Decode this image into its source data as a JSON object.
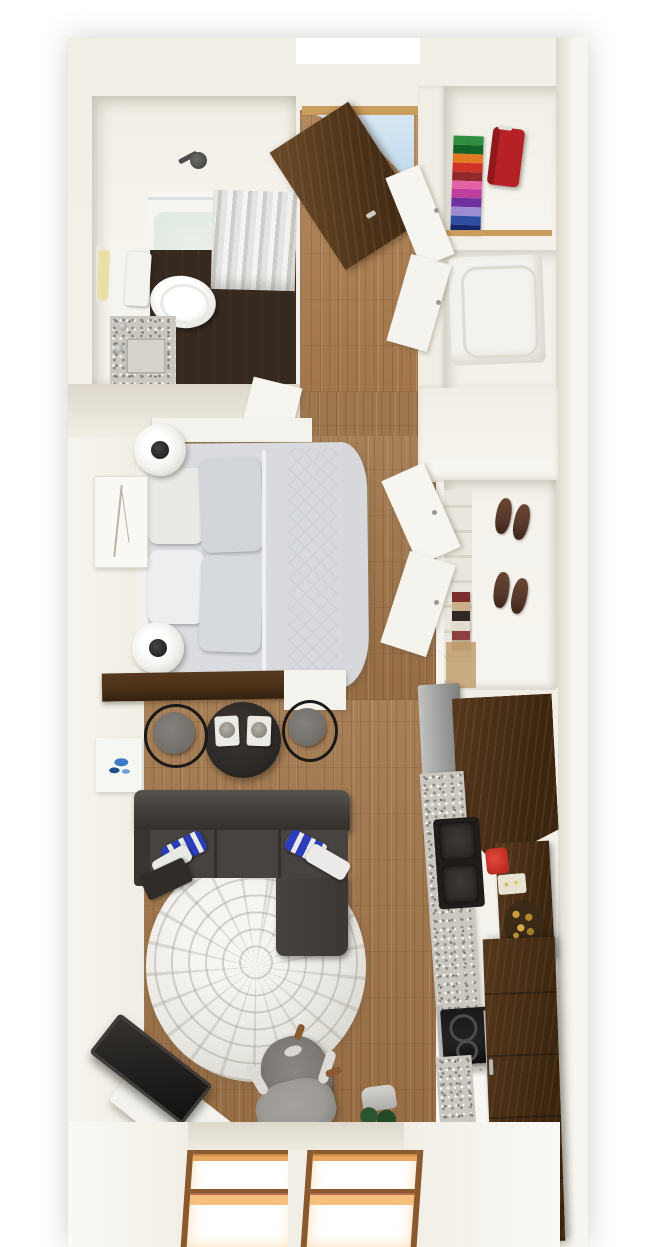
{
  "meta": {
    "description": "3D top-down architectural rendering of a narrow studio apartment floor plan",
    "view": "overhead dollhouse render",
    "visible_text": "none"
  },
  "palette": {
    "wall": "#f1eee5",
    "wall-bright": "#f7f5f0",
    "wall-shade": "#ddd8cb",
    "wood": "#a0754a",
    "wood-dark": "#6f4e2e",
    "bath-floor": "#36291f",
    "tub-water": "#dde7e0",
    "curtain": "#cdcdca",
    "white-fixture": "#f6f5f1",
    "granite": "#cac7c0",
    "door": "#4f3419",
    "door-light": "#6b4a28",
    "sky": "#bdd7ea",
    "shelf-wood": "#c89d5e",
    "suitcase": "#b52125",
    "washer": "#f3f2ee",
    "bed": "#dcdee1",
    "bed-quilt": "#cfd3d7",
    "pillow-white": "#e9e9e6",
    "pillow-gray": "#d2d6da",
    "lamp-white": "#f2f1ed",
    "lamp-black": "#161616",
    "art-blue": "#3d7cc2",
    "branch": "#b9b3a6",
    "shoe": "#55382b",
    "towel": "#eadfa4",
    "cabinet": "#4c3119",
    "fridge": "#a2a2a0",
    "sink": "#2e2a26",
    "red": "#bf2b22",
    "fruit": "#c79c40",
    "sofa": "#403c38",
    "sofa-dark": "#2f2c29",
    "cushion": "#474340",
    "pillow-blue": "#2b3dbb",
    "rug": "#e9e8e3",
    "table": "#2b2826",
    "seat": "#716d69",
    "stool-frame": "#1b1918",
    "tv": "#242220",
    "chair": "#7c7874",
    "chair-light": "#9d9995",
    "plant": "#2b5530",
    "plant-dark": "#1d3d22",
    "window-frame": "#8a5a2e",
    "window-amber": "#e8a75f",
    "window-glow": "#f6c07c"
  },
  "clothes_stack_colors": [
    "#2f8f3f",
    "#146326",
    "#e0791f",
    "#cf3327",
    "#93292d",
    "#e363a5",
    "#bf3f9f",
    "#6e309e",
    "#9c8cd2",
    "#2e4da3",
    "#16266b"
  ],
  "folded_textile_colors": [
    "#7c2d2d",
    "#c9b089",
    "#2f2824",
    "#e3dccd",
    "#8c4040",
    "#bda98c"
  ],
  "rooms": {
    "bathroom": {
      "label": "Bathroom with shower-tub, curtain, toilet and granite vanity"
    },
    "entry": {
      "label": "Entry hall with open wooden front door"
    },
    "linen_closet": {
      "label": "Closet with folded clothes stack and red suitcase"
    },
    "laundry": {
      "label": "Laundry closet with front-load washer"
    },
    "bedroom": {
      "label": "Sleeping area with bed, pillows and round side tables"
    },
    "shoe_closet": {
      "label": "Closet with shoes and folded textiles"
    },
    "kitchen": {
      "label": "Galley kitchen with fridge, sink, cooktop and pantry"
    },
    "dining": {
      "label": "Round dining table with two stools and place settings"
    },
    "living": {
      "label": "Living area with sectional sofa, round rug, TV and desk chair"
    },
    "windows": {
      "label": "Two bottom-facing double-hung windows"
    }
  }
}
